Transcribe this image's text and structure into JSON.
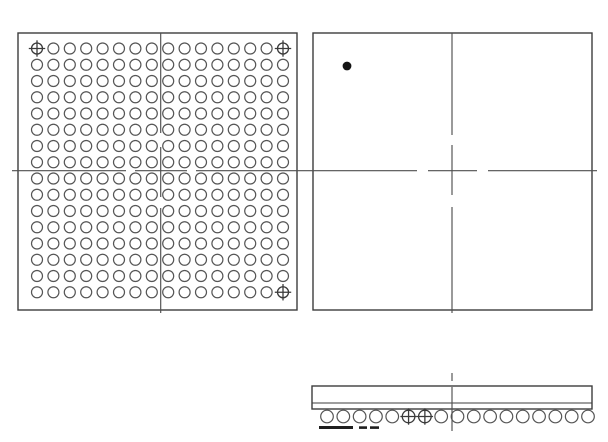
{
  "canvas": {
    "width": 608,
    "height": 442,
    "background": "#ffffff"
  },
  "style": {
    "frame_color": "#3d3d3d",
    "frame_width": 1.4,
    "centerline_color": "#4f4f4f",
    "centerline_width": 1.15,
    "ball_color": "#555555",
    "ball_stroke_width": 1.2,
    "fiducial_color": "#3a3a3a",
    "fiducial_stroke_width": 1.3,
    "mark_color": "#1f1f1f",
    "dot_color": "#141414"
  },
  "bottom_view": {
    "frame": {
      "x": 18,
      "y": 33,
      "w": 279,
      "h": 277
    },
    "grid": {
      "rows": 16,
      "cols": 16,
      "x0": 37,
      "y0": 48.5,
      "dx": 16.4,
      "dy": 16.25,
      "ball_radius": 5.5
    },
    "fiducials": [
      [
        0,
        0
      ],
      [
        0,
        15
      ],
      [
        15,
        15
      ]
    ],
    "fiducial_arm": 8.2,
    "centerlines": [
      [
        12,
        170.7,
        126,
        170.7
      ],
      [
        135,
        170.7,
        187,
        170.7
      ],
      [
        196,
        170.7,
        306,
        170.7
      ],
      [
        160.7,
        33,
        160.7,
        133
      ],
      [
        160.7,
        147,
        160.7,
        197
      ],
      [
        160.7,
        208,
        160.7,
        313
      ]
    ]
  },
  "top_view": {
    "frame": {
      "x": 313,
      "y": 33,
      "w": 279,
      "h": 277
    },
    "a1_dot": {
      "cx": 347,
      "cy": 66,
      "r": 4.4
    },
    "centerlines": [
      [
        306,
        170.7,
        417,
        170.7
      ],
      [
        428,
        170.7,
        477,
        170.7
      ],
      [
        488,
        170.7,
        597,
        170.7
      ],
      [
        452,
        33,
        452,
        135
      ],
      [
        452,
        145,
        452,
        195
      ],
      [
        452,
        207,
        452,
        313
      ]
    ]
  },
  "side_view": {
    "body": {
      "x": 312,
      "y": 386,
      "w": 280,
      "h": 23
    },
    "substrate_line_y": 403,
    "balls": {
      "count": 17,
      "x0": 327,
      "pitch": 16.3125,
      "cy": 416.5,
      "r": 6.3
    },
    "cross_ball_indices": [
      5,
      6
    ],
    "cross_arm": 8.2,
    "datum_marks": [
      {
        "x": 319,
        "y": 426,
        "w": 34,
        "h": 3
      },
      {
        "x": 359,
        "y": 426.3,
        "w": 8,
        "h": 2.6
      },
      {
        "x": 370,
        "y": 426.3,
        "w": 9,
        "h": 2.6
      }
    ],
    "centerlines": [
      [
        452,
        373,
        452,
        381
      ],
      [
        452,
        387,
        452,
        431
      ]
    ]
  }
}
